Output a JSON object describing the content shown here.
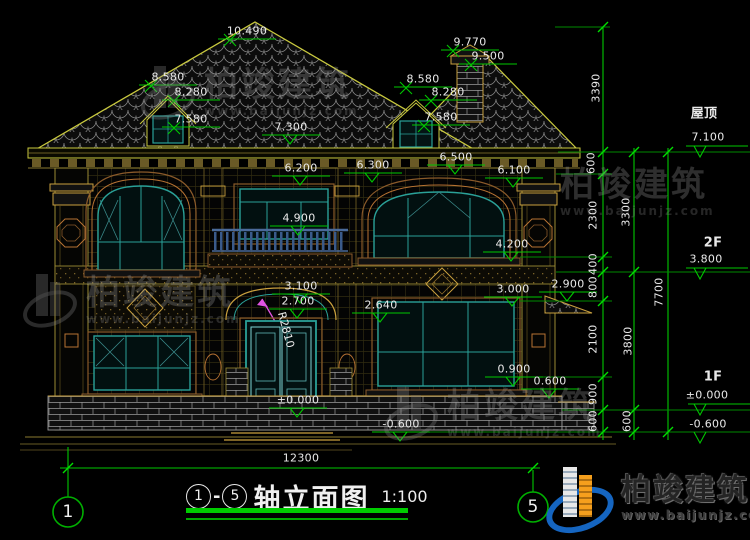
{
  "title": {
    "circle_start": "1",
    "dash": "-",
    "circle_end": "5",
    "name": "轴立面图",
    "scale": "1:100"
  },
  "brand": {
    "name": "柏竣建筑",
    "url": "www.baijunjz.com"
  },
  "overall_dim": "12300",
  "colors": {
    "dim_green": "#00c800",
    "bright_green": "#00e000",
    "outline_yellow": "#c9c93e",
    "trim_brown": "#b87333",
    "window_teal": "#2aa198",
    "door_cyan": "#7fd4d4",
    "magenta": "#e254e2",
    "logo_blue": "#1565c0",
    "logo_orange": "#f59f1d"
  },
  "levels_right": [
    {
      "name": "屋顶",
      "elev": "7.100"
    },
    {
      "name": "2F",
      "elev": "3.800"
    },
    {
      "name": "1F",
      "elev": "±0.000"
    },
    {
      "name": "",
      "elev": "-0.600"
    }
  ],
  "labels": [
    {
      "t": "10.490",
      "x": 247,
      "y": 31,
      "m": "x"
    },
    {
      "t": "9.770",
      "x": 470,
      "y": 42,
      "m": "x"
    },
    {
      "t": "9.500",
      "x": 488,
      "y": 56,
      "m": "x"
    },
    {
      "t": "8.580",
      "x": 168,
      "y": 77,
      "m": "x"
    },
    {
      "t": "8.280",
      "x": 191,
      "y": 92,
      "m": "x"
    },
    {
      "t": "7.580",
      "x": 191,
      "y": 119,
      "m": "x"
    },
    {
      "t": "7.300",
      "x": 291,
      "y": 127,
      "m": "v"
    },
    {
      "t": "8.580",
      "x": 423,
      "y": 79,
      "m": "x"
    },
    {
      "t": "8.280",
      "x": 448,
      "y": 92,
      "m": "x"
    },
    {
      "t": "7.580",
      "x": 441,
      "y": 117,
      "m": "x"
    },
    {
      "t": "6.200",
      "x": 301,
      "y": 168,
      "m": "v"
    },
    {
      "t": "6.300",
      "x": 373,
      "y": 165,
      "m": "v"
    },
    {
      "t": "6.500",
      "x": 456,
      "y": 157,
      "m": "v"
    },
    {
      "t": "6.100",
      "x": 514,
      "y": 170,
      "m": "v"
    },
    {
      "t": "4.900",
      "x": 299,
      "y": 218,
      "m": "v"
    },
    {
      "t": "4.200",
      "x": 512,
      "y": 244,
      "m": "v"
    },
    {
      "t": "3.100",
      "x": 301,
      "y": 286,
      "m": "v"
    },
    {
      "t": "2.700",
      "x": 298,
      "y": 301,
      "m": "v"
    },
    {
      "t": "2.640",
      "x": 381,
      "y": 305,
      "m": "v"
    },
    {
      "t": "3.000",
      "x": 513,
      "y": 289,
      "m": "v"
    },
    {
      "t": "2.900",
      "x": 568,
      "y": 284,
      "m": "v"
    },
    {
      "t": "0.900",
      "x": 514,
      "y": 369,
      "m": "v"
    },
    {
      "t": "0.600",
      "x": 550,
      "y": 381,
      "m": "v"
    },
    {
      "t": "±0.000",
      "x": 298,
      "y": 400,
      "m": "v"
    },
    {
      "t": "-0.600",
      "x": 401,
      "y": 424,
      "m": "v"
    },
    {
      "t": "R2810",
      "x": 286,
      "y": 330,
      "r": 75
    },
    {
      "t": "3390",
      "x": 596,
      "y": 88,
      "r": -90
    },
    {
      "t": "600",
      "x": 591,
      "y": 163,
      "r": -90
    },
    {
      "t": "2300",
      "x": 593,
      "y": 215,
      "r": -90
    },
    {
      "t": "400",
      "x": 593,
      "y": 264,
      "r": -90
    },
    {
      "t": "800",
      "x": 593,
      "y": 287,
      "r": -90
    },
    {
      "t": "2100",
      "x": 593,
      "y": 339,
      "r": -90
    },
    {
      "t": "900",
      "x": 593,
      "y": 394,
      "r": -90
    },
    {
      "t": "600",
      "x": 593,
      "y": 421,
      "r": -90
    },
    {
      "t": "3300",
      "x": 626,
      "y": 212,
      "r": -90
    },
    {
      "t": "3800",
      "x": 628,
      "y": 341,
      "r": -90
    },
    {
      "t": "600",
      "x": 627,
      "y": 421,
      "r": -90
    },
    {
      "t": "7700",
      "x": 659,
      "y": 292,
      "r": -90
    },
    {
      "t": "屋顶",
      "x": 704,
      "y": 112,
      "c": "big"
    },
    {
      "t": "7.100",
      "x": 708,
      "y": 137
    },
    {
      "t": "2F",
      "x": 713,
      "y": 243,
      "c": "big"
    },
    {
      "t": "3.800",
      "x": 706,
      "y": 259
    },
    {
      "t": "1F",
      "x": 713,
      "y": 377,
      "c": "big"
    },
    {
      "t": "±0.000",
      "x": 707,
      "y": 395
    },
    {
      "t": "-0.600",
      "x": 708,
      "y": 424
    },
    {
      "t": "12300",
      "x": 301,
      "y": 458
    },
    {
      "t": "1",
      "x": 68,
      "y": 512,
      "c": "bub"
    },
    {
      "t": "5",
      "x": 533,
      "y": 507,
      "c": "bub"
    }
  ]
}
